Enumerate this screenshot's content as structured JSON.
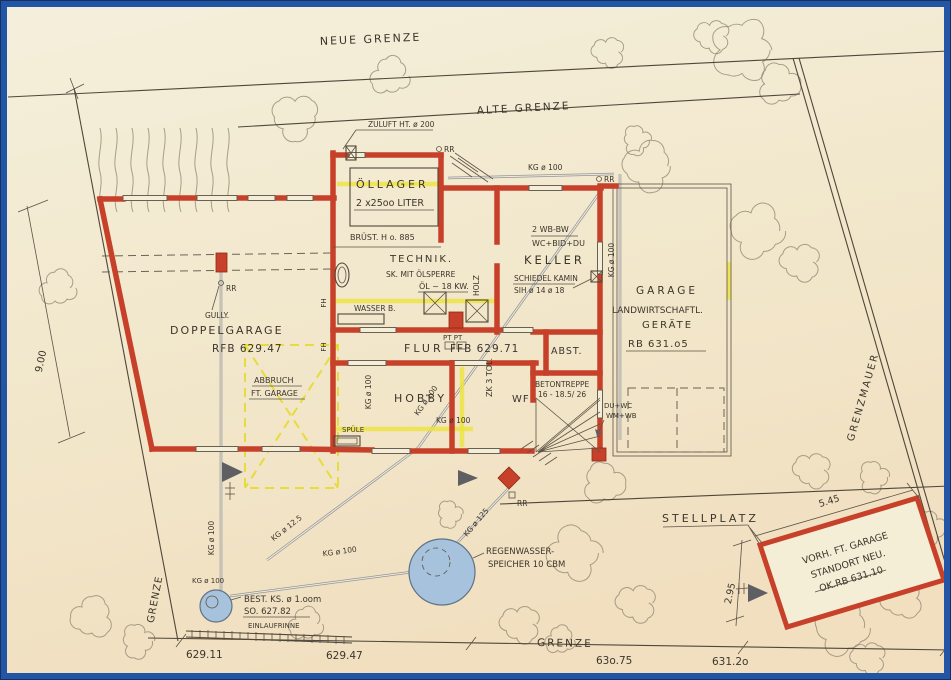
{
  "colors": {
    "paper": "#f2e9cf",
    "frame_blue": "#2355a6",
    "wall_red": "#c7402a",
    "highlight_yellow": "#ece33c",
    "water_blue": "#a6c2dc",
    "ink": "#3b362c"
  },
  "boundaries": {
    "neue_grenze": "NEUE GRENZE",
    "alte_grenze": "ALTE GRENZE",
    "grenzmauer": "GRENZMAUER",
    "grenze_left": "GRENZE",
    "grenze_bottom": "GRENZE"
  },
  "dimensions": {
    "left_offset": "9.00",
    "garage_width": "5.45",
    "garage_offset": "2.95"
  },
  "elevations": {
    "p1": "629.11",
    "p2": "629.47",
    "p3": "63o.75",
    "p4": "631.2o"
  },
  "rooms": {
    "doppelgarage": {
      "name": "DOPPELGARAGE",
      "level": "RFB 629.47",
      "gully": "GULLY."
    },
    "oellager": {
      "name": "ÖLLAGER",
      "tanks": "2 x25oo LITER",
      "bruestung": "BRÜST. H o. 885"
    },
    "technik": {
      "name": "TECHNIK.",
      "sink_note": "SK. MIT ÖLSPERRE",
      "boiler": "ÖL ~ 18 KW.",
      "wood": "HOLZ",
      "water": "WASSER B.",
      "pt": "PT PT"
    },
    "keller": {
      "name": "KELLER",
      "fixtures1": "2 WB-BW",
      "fixtures2": "WC+BID+DU",
      "kamin1": "SCHIEDEL KAMIN",
      "kamin2": "SIH ø 14 ø 18"
    },
    "flur": {
      "name": "FLUR",
      "level": "FFB 629.71"
    },
    "hobby": {
      "name": "HOBBY",
      "sink": "SPÜLE"
    },
    "abstellraum": {
      "name": "ABST."
    },
    "windfang": {
      "name": "WF",
      "zk": "ZK 3 TOL."
    },
    "treppe": {
      "name": "BETONTREPPE",
      "steps": "16 - 18.5/ 26"
    },
    "garage_geraete": {
      "name1": "GARAGE",
      "name2": "LANDWIRTSCHAFTL.",
      "name3": "GERÄTE",
      "level": "RB 631.o5",
      "future1": "DU+WC",
      "future2": "WM+WB"
    },
    "abbruch": {
      "line1": "ABBRUCH",
      "line2": "FT. GARAGE"
    }
  },
  "site": {
    "stellplatz": "STELLPLATZ",
    "vorh_garage": {
      "line1": "VORH. FT. GARAGE",
      "line2": "STANDORT NEU.",
      "line3": "OK.RB 631.10"
    },
    "regenwasser": {
      "line1": "REGENWASSER-",
      "line2": "SPEICHER 10 CBM"
    },
    "schacht": {
      "line1": "BEST. KS. ø 1.oom",
      "line2": "SO. 627.82"
    },
    "einlaufrinne": "EINLAUFRINNE",
    "zuluft": "ZULUFT HT. ø 200"
  },
  "pipes": {
    "kg100": "KG ø 100",
    "kg125": "KG ø 125",
    "kg12_5": "KG ø 12.5",
    "rr": "RR",
    "fh": "FH"
  }
}
